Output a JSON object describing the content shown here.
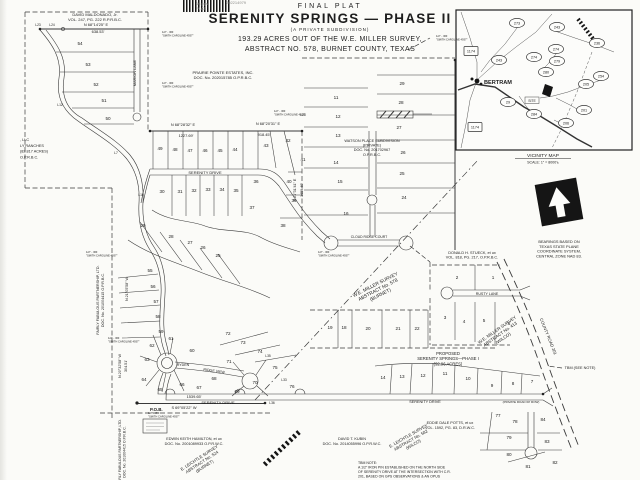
{
  "scan_stamps": {
    "pages": "16 pgs",
    "doc_type": "PLAT",
    "doc_number": "202214979"
  },
  "title_block": {
    "kicker": "FINAL PLAT",
    "title": "SERENITY SPRINGS — PHASE II",
    "subtitle": "(A PRIVATE SUBDIVISION)",
    "description_line1": "193.29 ACRES OUT OF THE W.E. MILLER SURVEY,",
    "description_line2": "ABSTRACT NO. 578, BURNET COUNTY, TEXAS"
  },
  "vicinity_map": {
    "caption": "VICINITY MAP",
    "scale": "SCALE: 1\" = 8000'±",
    "town": "BERTRAM",
    "site_label": "SITE",
    "routes": [
      {
        "label": "273",
        "x": 517,
        "y": 23
      },
      {
        "label": "243",
        "x": 557,
        "y": 27
      },
      {
        "label": "236",
        "x": 597,
        "y": 43
      },
      {
        "label": "1174",
        "x": 471,
        "y": 51,
        "shape": "box"
      },
      {
        "label": "274",
        "x": 556,
        "y": 49
      },
      {
        "label": "274",
        "x": 534,
        "y": 57
      },
      {
        "label": "243",
        "x": 499,
        "y": 60
      },
      {
        "label": "279",
        "x": 557,
        "y": 61
      },
      {
        "label": "280",
        "x": 546,
        "y": 72
      },
      {
        "label": "254",
        "x": 601,
        "y": 76
      },
      {
        "label": "205",
        "x": 586,
        "y": 84
      },
      {
        "label": "29",
        "x": 508,
        "y": 102
      },
      {
        "label": "201",
        "x": 584,
        "y": 110
      },
      {
        "label": "284",
        "x": 534,
        "y": 114
      },
      {
        "label": "206",
        "x": 566,
        "y": 123
      },
      {
        "label": "1174",
        "x": 475,
        "y": 127,
        "shape": "box"
      }
    ]
  },
  "plat": {
    "labels": [
      {
        "name": "owner-label",
        "lines": [
          "DAVID MALDONADO, Jr.",
          "VOL. 247, PG. 222 R.P.R.B.C."
        ],
        "x": 95,
        "y": 16,
        "size": 4,
        "lh": 5.2
      },
      {
        "name": "owner-label",
        "lines": [
          "PRAIRIE POINTE ESTATES, INC.",
          "DOC. No. 202015785 O.P.R.B.C."
        ],
        "x": 223,
        "y": 74,
        "size": 4,
        "lh": 5.2
      },
      {
        "name": "owner-label",
        "lines": [
          "WATSON PLACE SUBDIVISION",
          "(PRIVATE)",
          "DOC. No. 201702967",
          "O.P.R.B.C."
        ],
        "x": 372,
        "y": 142,
        "size": 3.8,
        "lh": 4.6
      },
      {
        "name": "owner-label",
        "lines": [
          "DONALD H. STUECK, et ux",
          "VOL. 818, PG. 217, O.P.R.B.C."
        ],
        "x": 472,
        "y": 254,
        "size": 3.8,
        "lh": 4.6
      },
      {
        "name": "survey-label",
        "lines": [
          "W.E. MILLER SURVEY",
          "ABSTRACT No. 578",
          "(BURNET)"
        ],
        "x": 376,
        "y": 286,
        "size": 4.8,
        "lh": 5.6,
        "rotate": -27
      },
      {
        "name": "survey-label",
        "lines": [
          "W.E. MILLER SURVEY",
          "ABSTRACT No. 413",
          "(WILCO)"
        ],
        "x": 498,
        "y": 331,
        "size": 4.4,
        "lh": 5.2,
        "rotate": -35
      },
      {
        "name": "phase1-label",
        "lines": [
          "PROPOSED",
          "SERENITY SPRINGS—PHASE I",
          "(92.96 ACRES)"
        ],
        "x": 448,
        "y": 355,
        "size": 4.2,
        "lh": 5.2
      },
      {
        "name": "owner-label",
        "lines": [
          "EDWIN KEITH HAMILTON, et ux",
          "DOC. No. 2001089933 O.P.R.W.C."
        ],
        "x": 194,
        "y": 440,
        "size": 3.8,
        "lh": 4.8
      },
      {
        "name": "survey-label",
        "lines": [
          "E. LEICHTLE SURVEY",
          "ABSTRACT No. 524",
          "(BURNET)"
        ],
        "x": 200,
        "y": 459,
        "size": 4.2,
        "lh": 5,
        "rotate": -33
      },
      {
        "name": "owner-label",
        "lines": [
          "DAVID T. KUBIN",
          "DOC. No. 2014055996 O.P.R.W.C."
        ],
        "x": 352,
        "y": 440,
        "size": 3.8,
        "lh": 4.8
      },
      {
        "name": "owner-label",
        "lines": [
          "EDDIE DALE POTTS, et ux",
          "VOL. 1592, PG. 83, D.R.W.C."
        ],
        "x": 450,
        "y": 424,
        "size": 3.8,
        "lh": 4.8
      },
      {
        "name": "survey-label",
        "lines": [
          "E. LEICHTLE SURVEY",
          "ABSTRACT No. 582",
          "(WILCO)"
        ],
        "x": 409,
        "y": 437,
        "size": 4.2,
        "lh": 5,
        "rotate": -30
      },
      {
        "name": "owner-label",
        "lines": [
          "FAIRLY FABULOUS PARTNERSHIP, LTD.",
          "DOC. No. 201004415 O.P.R.B.C."
        ],
        "x": 99,
        "y": 300,
        "size": 3.7,
        "lh": 5,
        "rotate": -90
      },
      {
        "name": "owner-label",
        "lines": [
          "FAIRLY FABULOUS PARTNERSHIP, LTD.",
          "DOC. No. 201004415 O.P.R.B.C."
        ],
        "x": 121,
        "y": 452,
        "size": 3.5,
        "lh": 4.6,
        "rotate": -90
      },
      {
        "name": "owner-label",
        "lines": [
          ", LLC",
          "LY RANCHES",
          "(82.817 ACRES)",
          "O.P.R.B.C."
        ],
        "x": 20,
        "y": 141,
        "size": 3.8,
        "lh": 5.8,
        "anchor": "start"
      },
      {
        "name": "bearing-label",
        "text": "N 68°14'25\" E",
        "x": 96,
        "y": 26,
        "size": 3.9
      },
      {
        "name": "distance-label",
        "text": "638.53'",
        "x": 98,
        "y": 33,
        "size": 3.9
      },
      {
        "name": "bearing-label",
        "text": "N 68°28'32\" E",
        "x": 183,
        "y": 126,
        "size": 3.9
      },
      {
        "name": "distance-label",
        "text": "1227.69'",
        "x": 186,
        "y": 137,
        "size": 3.9
      },
      {
        "name": "bearing-label",
        "text": "N 68°20'31\" E",
        "x": 268,
        "y": 125,
        "size": 3.9
      },
      {
        "name": "distance-label",
        "text": "918.45'",
        "x": 264,
        "y": 136,
        "size": 3.9
      },
      {
        "name": "distance-label",
        "text": "1539.65'",
        "x": 194,
        "y": 398,
        "size": 3.9
      },
      {
        "name": "bearing-label",
        "text": "S 69°05'22\" W",
        "x": 184,
        "y": 409,
        "size": 3.9
      },
      {
        "name": "bearing-label",
        "text": "N 21°05'58\" W",
        "x": 128,
        "y": 289,
        "size": 3.7,
        "rotate": -90
      },
      {
        "name": "bearing-label",
        "text": "N 20°32'58\" W",
        "x": 121,
        "y": 366,
        "size": 3.7,
        "rotate": -90
      },
      {
        "name": "distance-label",
        "text": "304.51'",
        "x": 127,
        "y": 366,
        "size": 3.7,
        "rotate": -90
      },
      {
        "name": "bearing-label",
        "text": "S 21°31'41\" E",
        "x": 296,
        "y": 190,
        "size": 3.7,
        "rotate": -90
      },
      {
        "name": "distance-label",
        "text": "1459.40'",
        "x": 303,
        "y": 190,
        "size": 3.7,
        "rotate": -90
      },
      {
        "name": "road-label",
        "text": "MARION LANE",
        "x": 136,
        "y": 73,
        "size": 3.8,
        "rotate": -90
      },
      {
        "name": "road-label",
        "text": "SERENITY DRIVE",
        "x": 205,
        "y": 174,
        "size": 4
      },
      {
        "name": "road-label",
        "text": "SERENITY DRIVE",
        "x": 218,
        "y": 404,
        "size": 4
      },
      {
        "name": "road-label",
        "text": "SERENITY DRIVE",
        "x": 425,
        "y": 403,
        "size": 3.8
      },
      {
        "name": "road-label",
        "text": "(PRIVATE ROAD 60' ROW)",
        "x": 521,
        "y": 403,
        "size": 3
      },
      {
        "name": "road-label",
        "text": "RUSTY LANE",
        "x": 487,
        "y": 295,
        "size": 3.6
      },
      {
        "name": "road-label",
        "text": "RYDEN",
        "x": 183,
        "y": 366,
        "size": 3.6
      },
      {
        "name": "road-label",
        "text": "RIDGE VIEW",
        "x": 214,
        "y": 372,
        "size": 3.6,
        "rotate": 8
      },
      {
        "name": "road-label",
        "text": "CLOUD RIDGE COURT",
        "x": 369,
        "y": 238,
        "size": 3.4
      },
      {
        "name": "road-label",
        "text": "COUNTY ROAD 201",
        "x": 547,
        "y": 337,
        "size": 4.2,
        "rotate": 68
      },
      {
        "name": "poi-label",
        "text": "P.O.B.",
        "x": 150,
        "y": 411,
        "size": 4.4,
        "bold": true,
        "anchor": "start"
      },
      {
        "name": "poi-label",
        "text": "TBM (SEE NOTE)",
        "x": 580,
        "y": 369,
        "size": 3.8
      },
      {
        "name": "line-label",
        "text": "L23",
        "x": 38,
        "y": 26,
        "size": 3.3
      },
      {
        "name": "line-label",
        "text": "L24",
        "x": 52,
        "y": 26,
        "size": 3.3
      },
      {
        "name": "line-label",
        "text": "L12",
        "x": 60,
        "y": 106,
        "size": 3.3
      },
      {
        "name": "line-label",
        "text": "L7",
        "x": 116,
        "y": 154,
        "size": 3.3
      },
      {
        "name": "line-label",
        "text": "L10",
        "x": 141,
        "y": 196,
        "size": 3.3
      },
      {
        "name": "line-label",
        "text": "L28",
        "x": 303,
        "y": 116,
        "size": 3.3
      },
      {
        "name": "line-label",
        "text": "L35",
        "x": 268,
        "y": 357,
        "size": 3.3
      },
      {
        "name": "line-label",
        "text": "L33",
        "x": 284,
        "y": 381,
        "size": 3.3
      },
      {
        "name": "line-label",
        "text": "L36",
        "x": 272,
        "y": 404,
        "size": 3.3
      },
      {
        "name": "monument-note",
        "lines": [
          "1/2\" - IRF",
          "\"SMITH CAROLINE 4937\""
        ],
        "x": 162,
        "y": 33,
        "size": 2.7,
        "lh": 3.3,
        "anchor": "start"
      },
      {
        "name": "monument-note",
        "lines": [
          "1/2\" - IRF",
          "\"SMITH CAROLINE 4937\""
        ],
        "x": 162,
        "y": 84,
        "size": 2.7,
        "lh": 3.3,
        "anchor": "start"
      },
      {
        "name": "monument-note",
        "lines": [
          "1/2\" - IRF",
          "\"SMITH CAROLINE 4937\""
        ],
        "x": 436,
        "y": 37,
        "size": 2.7,
        "lh": 3.3,
        "anchor": "start"
      },
      {
        "name": "monument-note",
        "lines": [
          "1/2\" - IRF",
          "\"SMITH CAROLINE 4937\""
        ],
        "x": 86,
        "y": 253,
        "size": 2.7,
        "lh": 3.3,
        "anchor": "start"
      },
      {
        "name": "monument-note",
        "lines": [
          "1/2\" - IRF",
          "\"SMITH CAROLINE 4937\""
        ],
        "x": 108,
        "y": 339,
        "size": 2.7,
        "lh": 3.3,
        "anchor": "start"
      },
      {
        "name": "monument-note",
        "lines": [
          "1/2\" - IRF",
          "\"SMITH CAROLINE 4937\""
        ],
        "x": 148,
        "y": 414,
        "size": 2.7,
        "lh": 3.3,
        "anchor": "start"
      },
      {
        "name": "monument-note",
        "lines": [
          "1/2\" - IRF",
          "\"SMITH CAROLINE 4937\""
        ],
        "x": 318,
        "y": 253,
        "size": 2.7,
        "lh": 3.3,
        "anchor": "start"
      },
      {
        "name": "monument-note",
        "lines": [
          "1/2\" - IRF",
          "\"SMITH CAROLINE 4937\""
        ],
        "x": 274,
        "y": 112,
        "size": 2.7,
        "lh": 3.3,
        "anchor": "start"
      },
      {
        "name": "tbm-note",
        "lines": [
          "TBM NOTE:",
          "A 1/2\" IRON PIN ESTABLISHED ON THE NORTH SIDE",
          "OF SERENITY DRIVE AT THE INTERSECTION WITH C.R.",
          "201, BASED ON GPS OBSERVATIONS & AN OPUS"
        ],
        "x": 358,
        "y": 464,
        "size": 3.5,
        "lh": 4.5,
        "anchor": "start"
      },
      {
        "name": "north-note",
        "lines": [
          "BEARINGS BASED ON",
          "TEXAS STATE PLANE",
          "COORDINATE SYSTEM,",
          "CENTRAL ZONE NAD 83."
        ],
        "x": 559,
        "y": 243,
        "size": 3.9,
        "lh": 4.8
      }
    ],
    "lot_numbers": [
      {
        "n": "54",
        "x": 80,
        "y": 45
      },
      {
        "n": "53",
        "x": 88,
        "y": 66
      },
      {
        "n": "52",
        "x": 96,
        "y": 86
      },
      {
        "n": "51",
        "x": 104,
        "y": 102
      },
      {
        "n": "50",
        "x": 108,
        "y": 120
      },
      {
        "n": "49",
        "x": 160,
        "y": 150
      },
      {
        "n": "48",
        "x": 175,
        "y": 151
      },
      {
        "n": "47",
        "x": 190,
        "y": 152
      },
      {
        "n": "46",
        "x": 205,
        "y": 152
      },
      {
        "n": "45",
        "x": 220,
        "y": 152
      },
      {
        "n": "44",
        "x": 235,
        "y": 151
      },
      {
        "n": "43",
        "x": 266,
        "y": 147
      },
      {
        "n": "42",
        "x": 288,
        "y": 142
      },
      {
        "n": "41",
        "x": 303,
        "y": 161
      },
      {
        "n": "40",
        "x": 289,
        "y": 183
      },
      {
        "n": "39",
        "x": 294,
        "y": 202
      },
      {
        "n": "38",
        "x": 283,
        "y": 227
      },
      {
        "n": "37",
        "x": 252,
        "y": 209
      },
      {
        "n": "36",
        "x": 256,
        "y": 183
      },
      {
        "n": "35",
        "x": 236,
        "y": 192
      },
      {
        "n": "34",
        "x": 222,
        "y": 191
      },
      {
        "n": "33",
        "x": 208,
        "y": 191
      },
      {
        "n": "32",
        "x": 194,
        "y": 192
      },
      {
        "n": "31",
        "x": 180,
        "y": 193
      },
      {
        "n": "30",
        "x": 162,
        "y": 193
      },
      {
        "n": "29",
        "x": 143,
        "y": 227
      },
      {
        "n": "28",
        "x": 171,
        "y": 238
      },
      {
        "n": "27",
        "x": 190,
        "y": 244
      },
      {
        "n": "26",
        "x": 203,
        "y": 249
      },
      {
        "n": "25",
        "x": 218,
        "y": 257
      },
      {
        "n": "55",
        "x": 150,
        "y": 272
      },
      {
        "n": "56",
        "x": 153,
        "y": 288
      },
      {
        "n": "57",
        "x": 156,
        "y": 303
      },
      {
        "n": "58",
        "x": 158,
        "y": 318
      },
      {
        "n": "59",
        "x": 161,
        "y": 333
      },
      {
        "n": "61",
        "x": 171,
        "y": 340
      },
      {
        "n": "60",
        "x": 192,
        "y": 352
      },
      {
        "n": "62",
        "x": 152,
        "y": 347
      },
      {
        "n": "63",
        "x": 147,
        "y": 361
      },
      {
        "n": "64",
        "x": 144,
        "y": 381
      },
      {
        "n": "65",
        "x": 160,
        "y": 391
      },
      {
        "n": "66",
        "x": 182,
        "y": 386
      },
      {
        "n": "67",
        "x": 199,
        "y": 389
      },
      {
        "n": "68",
        "x": 214,
        "y": 380
      },
      {
        "n": "69",
        "x": 237,
        "y": 393
      },
      {
        "n": "70",
        "x": 255,
        "y": 384
      },
      {
        "n": "71",
        "x": 229,
        "y": 363
      },
      {
        "n": "72",
        "x": 228,
        "y": 335
      },
      {
        "n": "73",
        "x": 243,
        "y": 344
      },
      {
        "n": "74",
        "x": 260,
        "y": 353
      },
      {
        "n": "75",
        "x": 275,
        "y": 369
      },
      {
        "n": "76",
        "x": 292,
        "y": 388
      },
      {
        "n": "11",
        "x": 336,
        "y": 99
      },
      {
        "n": "12",
        "x": 338,
        "y": 118
      },
      {
        "n": "13",
        "x": 338,
        "y": 137
      },
      {
        "n": "14",
        "x": 336,
        "y": 164
      },
      {
        "n": "15",
        "x": 340,
        "y": 183
      },
      {
        "n": "16",
        "x": 346,
        "y": 215
      },
      {
        "n": "29",
        "x": 402,
        "y": 85
      },
      {
        "n": "28",
        "x": 401,
        "y": 104
      },
      {
        "n": "27",
        "x": 399,
        "y": 129
      },
      {
        "n": "26",
        "x": 403,
        "y": 154
      },
      {
        "n": "25",
        "x": 402,
        "y": 175
      },
      {
        "n": "24",
        "x": 404,
        "y": 199
      },
      {
        "n": "2",
        "x": 457,
        "y": 279
      },
      {
        "n": "1",
        "x": 493,
        "y": 279
      },
      {
        "n": "3",
        "x": 445,
        "y": 319
      },
      {
        "n": "4",
        "x": 464,
        "y": 323
      },
      {
        "n": "5",
        "x": 484,
        "y": 322
      },
      {
        "n": "6",
        "x": 509,
        "y": 325
      },
      {
        "n": "19",
        "x": 330,
        "y": 329
      },
      {
        "n": "18",
        "x": 344,
        "y": 329
      },
      {
        "n": "20",
        "x": 368,
        "y": 330
      },
      {
        "n": "21",
        "x": 398,
        "y": 330
      },
      {
        "n": "22",
        "x": 417,
        "y": 330
      },
      {
        "n": "14",
        "x": 383,
        "y": 379
      },
      {
        "n": "13",
        "x": 402,
        "y": 378
      },
      {
        "n": "12",
        "x": 423,
        "y": 377
      },
      {
        "n": "11",
        "x": 445,
        "y": 375
      },
      {
        "n": "10",
        "x": 468,
        "y": 380
      },
      {
        "n": "9",
        "x": 492,
        "y": 387
      },
      {
        "n": "8",
        "x": 513,
        "y": 385
      },
      {
        "n": "7",
        "x": 532,
        "y": 383
      },
      {
        "n": "77",
        "x": 498,
        "y": 417
      },
      {
        "n": "78",
        "x": 515,
        "y": 423
      },
      {
        "n": "84",
        "x": 543,
        "y": 421
      },
      {
        "n": "79",
        "x": 509,
        "y": 439
      },
      {
        "n": "83",
        "x": 547,
        "y": 443
      },
      {
        "n": "80",
        "x": 509,
        "y": 456
      },
      {
        "n": "81",
        "x": 528,
        "y": 468
      },
      {
        "n": "82",
        "x": 555,
        "y": 464
      }
    ]
  }
}
